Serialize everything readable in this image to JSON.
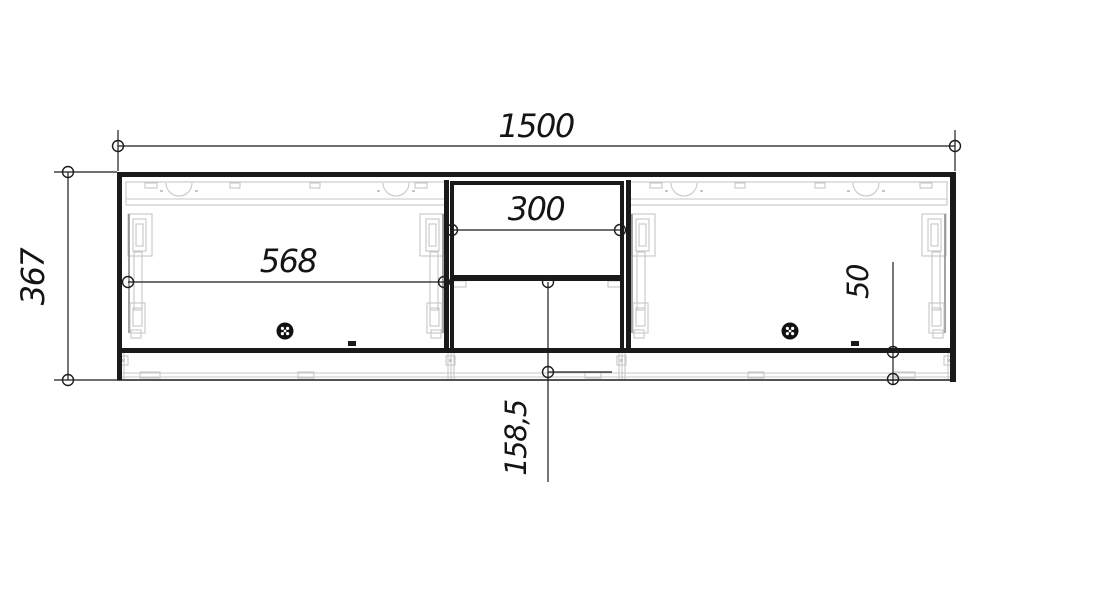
{
  "drawing": {
    "description": "cabinet-front-elevation-cad-drawing",
    "labels": {
      "total_width": "1500",
      "total_height": "367",
      "left_door_width": "568",
      "niche_width": "300",
      "niche_lower_height": "158,5",
      "plinth_height": "50"
    },
    "colors": {
      "line": "#1a1a1a",
      "hardware": "#c7c7c7",
      "background": "#ffffff"
    }
  }
}
